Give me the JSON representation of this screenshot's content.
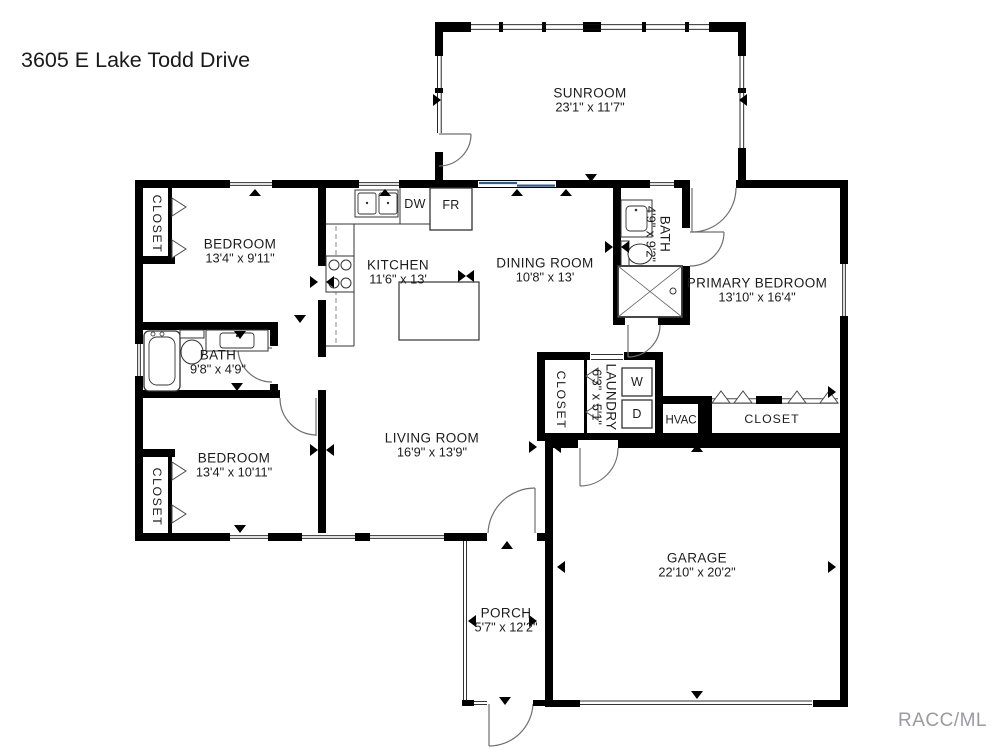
{
  "title": "3605 E Lake Todd Drive",
  "watermark": "RACC/ML",
  "closet_label": "CLOSET",
  "fixtures": {
    "dishwasher": "DW",
    "refrigerator": "FR",
    "washer": "W",
    "dryer": "D",
    "hvac": "HVAC"
  },
  "colors": {
    "wall": "#000000",
    "sliding_door_blue": "#2d5d8e",
    "watermark_gray": "#9a9aa0",
    "text": "#1c1c1c"
  },
  "rooms": {
    "sunroom": {
      "name": "SUNROOM",
      "dims": "23'1\" x 11'7\""
    },
    "bedroom_top": {
      "name": "BEDROOM",
      "dims": "13'4\" x 9'11\""
    },
    "kitchen": {
      "name": "KITCHEN",
      "dims": "11'6\" x 13'"
    },
    "dining": {
      "name": "DINING ROOM",
      "dims": "10'8\" x 13'"
    },
    "bath_hall": {
      "name": "BATH",
      "dims": "4'9\" x 9'2\""
    },
    "primary": {
      "name": "PRIMARY BEDROOM",
      "dims": "13'10\" x 16'4\""
    },
    "bath_left": {
      "name": "BATH",
      "dims": "9'8\" x 4'9\""
    },
    "bedroom_bottom": {
      "name": "BEDROOM",
      "dims": "13'4\" x 10'11\""
    },
    "living": {
      "name": "LIVING ROOM",
      "dims": "16'9\" x 13'9\""
    },
    "laundry": {
      "name": "LAUNDRY",
      "dims": "6'3\" x 5'1\""
    },
    "garage": {
      "name": "GARAGE",
      "dims": "22'10\" x 20'2\""
    },
    "porch": {
      "name": "PORCH",
      "dims": "5'7\" x 12'2\""
    }
  }
}
